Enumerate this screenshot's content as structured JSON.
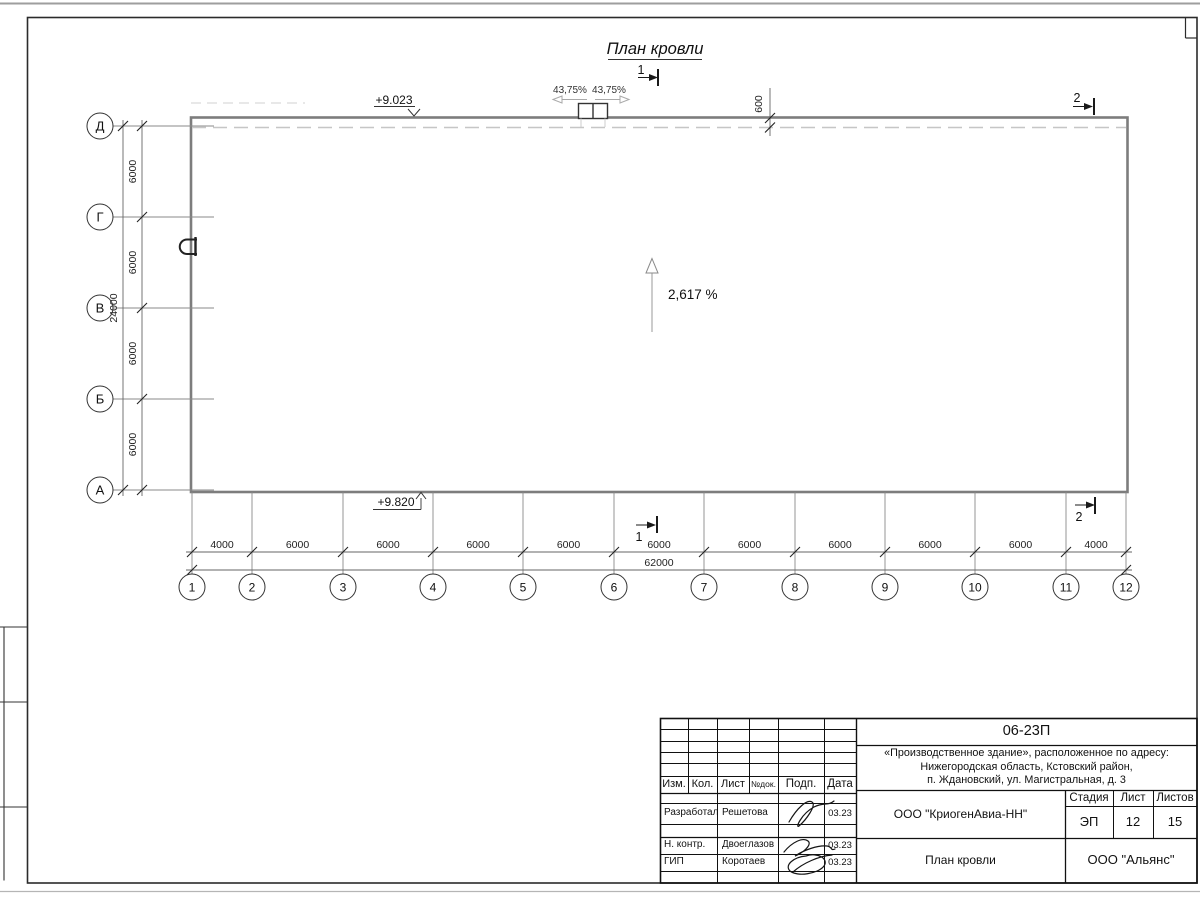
{
  "drawing": {
    "title": "План кровли",
    "slope_label": "2,617 %",
    "slope_left_pct": "43,75%",
    "slope_right_pct": "43,75%",
    "elevation_ridge": "+9.023",
    "elevation_eave": "+9.820",
    "parapet_offset": "600",
    "section_1": "1",
    "section_2": "2",
    "axes_rows": [
      "Д",
      "Г",
      "В",
      "Б",
      "А"
    ],
    "axes_cols": [
      "1",
      "2",
      "3",
      "4",
      "5",
      "6",
      "7",
      "8",
      "9",
      "10",
      "11",
      "12"
    ],
    "row_dims": [
      "6000",
      "6000",
      "6000",
      "6000"
    ],
    "row_total": "24000",
    "col_dims": [
      "4000",
      "6000",
      "6000",
      "6000",
      "6000",
      "6000",
      "6000",
      "6000",
      "6000",
      "6000",
      "4000"
    ],
    "col_total": "62000"
  },
  "titleblock": {
    "doc_number": "06-23П",
    "object_line1": "«Производственное здание», расположенное по адресу:",
    "object_line2": "Нижегородская область, Кстовский район,",
    "object_line3": "п. Ждановский, ул. Магистральная, д. 3",
    "col_izm": "Изм.",
    "col_kol": "Кол.",
    "col_list": "Лист",
    "col_ndok": "№док.",
    "col_podp": "Подп.",
    "col_data": "Дата",
    "rows": [
      {
        "role": "Разработал",
        "name": "Решетова",
        "date": "03.23"
      },
      {
        "role": "Н. контр.",
        "name": "Двоеглазов",
        "date": "03.23"
      },
      {
        "role": "ГИП",
        "name": "Коротаев",
        "date": "03.23"
      }
    ],
    "client": "ООО \"КриогенАвиа-НН\"",
    "sheet_name": "План кровли",
    "stage_label": "Стадия",
    "list_label": "Лист",
    "listov_label": "Листов",
    "stage": "ЭП",
    "list": "12",
    "listov": "15",
    "company": "ООО \"Альянс\""
  }
}
